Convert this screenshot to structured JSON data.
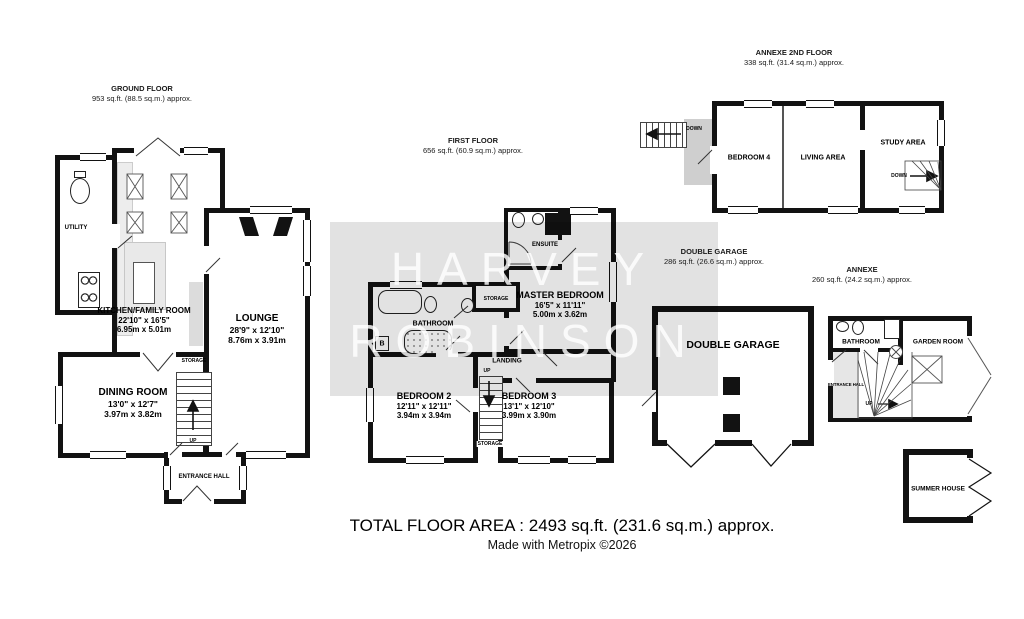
{
  "headers": {
    "ground": {
      "title": "GROUND FLOOR",
      "area": "953 sq.ft. (88.5 sq.m.) approx."
    },
    "first": {
      "title": "FIRST FLOOR",
      "area": "656 sq.ft. (60.9 sq.m.) approx."
    },
    "annexe2": {
      "title": "ANNEXE 2ND FLOOR",
      "area": "338 sq.ft. (31.4 sq.m.) approx."
    },
    "garage": {
      "title": "DOUBLE GARAGE",
      "area": "286 sq.ft. (26.6 sq.m.) approx."
    },
    "annexe": {
      "title": "ANNEXE",
      "area": "260 sq.ft. (24.2 sq.m.) approx."
    }
  },
  "rooms": {
    "kitchen": {
      "name": "KITCHEN/FAMILY ROOM",
      "ft": "22'10\" x 16'5\"",
      "m": "6.95m x 5.01m"
    },
    "lounge": {
      "name": "LOUNGE",
      "ft": "28'9\" x 12'10\"",
      "m": "8.76m x 3.91m"
    },
    "dining": {
      "name": "DINING ROOM",
      "ft": "13'0\" x 12'7\"",
      "m": "3.97m x 3.82m"
    },
    "master": {
      "name": "MASTER BEDROOM",
      "ft": "16'5\" x 11'11\"",
      "m": "5.00m x 3.62m"
    },
    "bedroom2": {
      "name": "BEDROOM 2",
      "ft": "12'11\" x 12'11\"",
      "m": "3.94m x 3.94m"
    },
    "bedroom3": {
      "name": "BEDROOM 3",
      "ft": "13'1\" x 12'10\"",
      "m": "3.99m x 3.90m"
    }
  },
  "labels": {
    "utility": "UTILITY",
    "storage": "STORAGE",
    "entrance_hall": "ENTRANCE HALL",
    "bathroom": "BATHROOM",
    "ensuite": "ENSUITE",
    "landing": "LANDING",
    "up": "UP",
    "down": "DOWN",
    "boiler": "B",
    "bedroom4": "BEDROOM 4",
    "living_area": "LIVING AREA",
    "study_area": "STUDY AREA",
    "double_garage": "DOUBLE GARAGE",
    "garden_room": "GARDEN ROOM",
    "summer_house": "SUMMER HOUSE"
  },
  "watermark": {
    "line1": "HARVEY",
    "line2": "ROBINSON"
  },
  "footer": {
    "total": "TOTAL FLOOR AREA : 2493 sq.ft. (231.6 sq.m.) approx.",
    "credit": "Made with Metropix ©2026"
  },
  "colors": {
    "wall": "#121212",
    "band": "#e0e0e0",
    "fixture_gray": "#e7e7e7"
  }
}
